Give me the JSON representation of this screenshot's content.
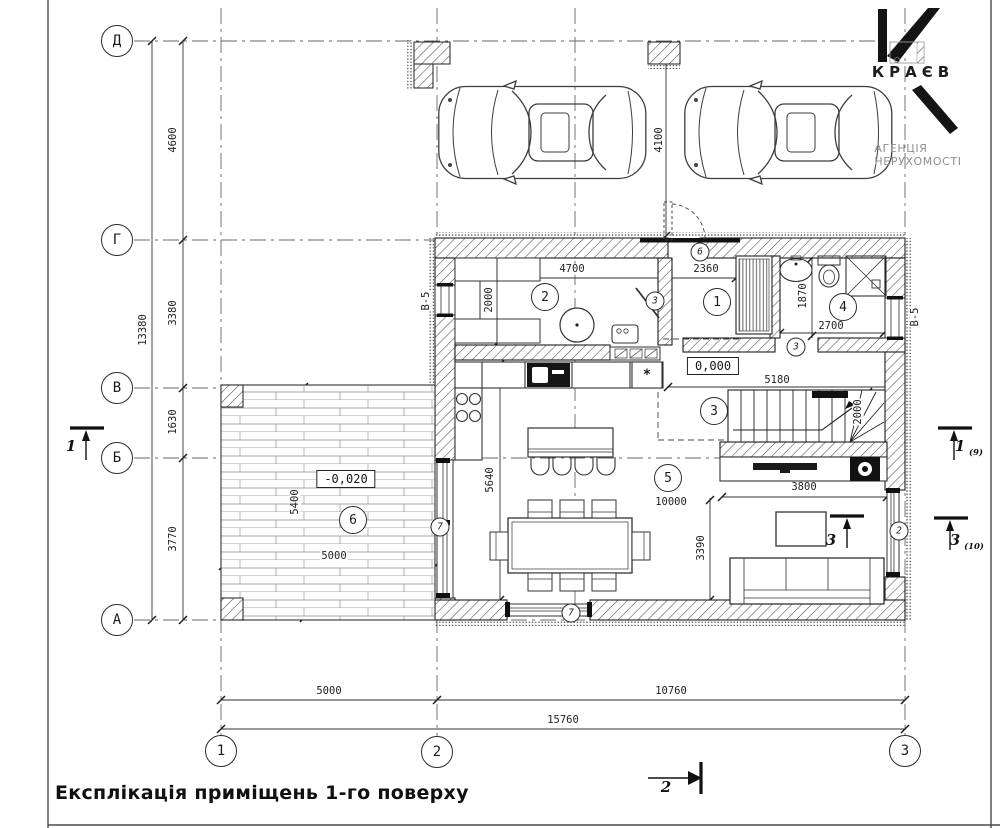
{
  "title": {
    "text": "Експлікація приміщень 1-го поверху"
  },
  "logo": {
    "brand": "КРАЄВ",
    "tagline": "АГЕНЦІЯ НЕРУХОМОСТІ"
  },
  "grid": {
    "rows": [
      "Д",
      "Г",
      "В",
      "Б",
      "А"
    ],
    "cols": [
      "1",
      "2",
      "3"
    ]
  },
  "dims": {
    "left_chain": [
      "4600",
      "3380",
      "1630",
      "3770"
    ],
    "left_total": "13380",
    "bottom_chain": [
      "5000",
      "10760"
    ],
    "bottom_total": "15760",
    "parking_depth": "4100",
    "kitchen_width": "4700",
    "kitchen_depth": "2000",
    "hall_width": "2360",
    "bath_depth": "1870",
    "bath_width": "2700",
    "stairs_run": "5180",
    "stairs_width": "2000",
    "tv_wall": "3800",
    "living_length": "10000",
    "living_depth": "5640",
    "sofa_zone": "3390",
    "terrace_depth": "5400",
    "terrace_width": "5000"
  },
  "levels": {
    "ground": "0,000",
    "terrace": "-0,020"
  },
  "rooms": [
    "1",
    "2",
    "3",
    "4",
    "5",
    "6"
  ],
  "refs": {
    "r2": "2",
    "r3": "3",
    "r6": "6",
    "r7": "7"
  },
  "windows": {
    "type": "В-5"
  },
  "sections": {
    "one": "1",
    "one_sheet": "(9)",
    "two": "2",
    "three": "3",
    "three_sheet": "(10)"
  },
  "symbols": {
    "hob": "*"
  }
}
